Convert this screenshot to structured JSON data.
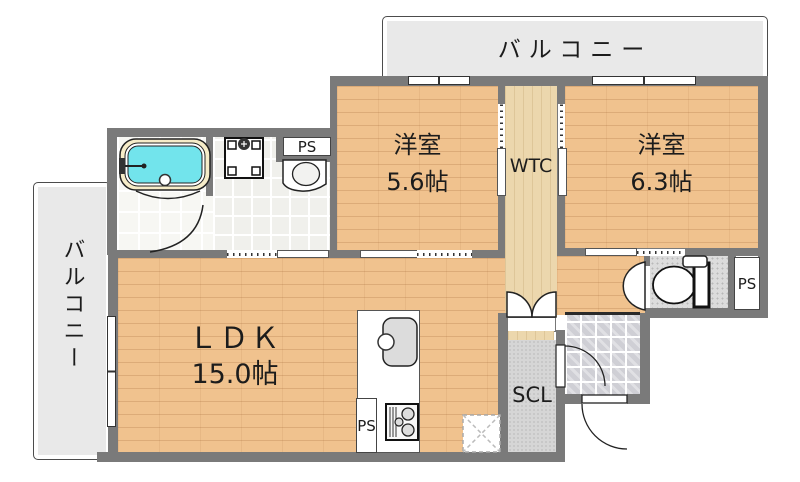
{
  "plan": {
    "balcony_top": "バルコニー",
    "balcony_left": "バルコニー",
    "bedroom1": {
      "name": "洋室",
      "size": "5.6帖"
    },
    "bedroom2": {
      "name": "洋室",
      "size": "6.3帖"
    },
    "ldk": {
      "name": "ＬＤＫ",
      "size": "15.0帖"
    },
    "wtc": "WTC",
    "scl": "SCL",
    "ps": "PS"
  },
  "colors": {
    "wall": "#7a7a7a",
    "wood": "#f0c28e",
    "wood-light": "#ecd7ad",
    "balcony": "#e9e9e9",
    "tub": "#72e4ec",
    "tile": "#f0f0ec",
    "ink": "#1c1c1c"
  }
}
